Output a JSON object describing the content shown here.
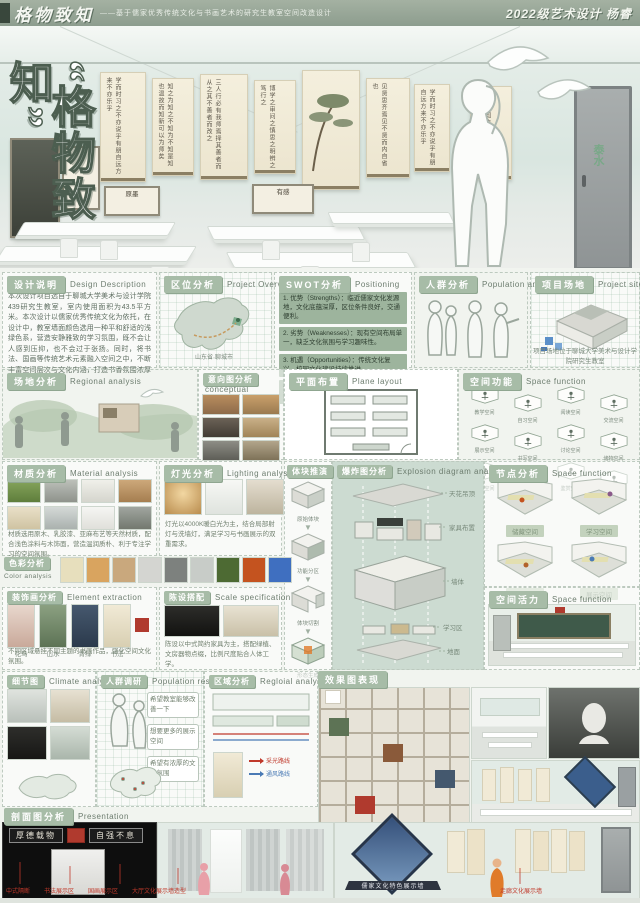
{
  "header": {
    "title": "格物致知",
    "subtitle": "——基于儒家优秀传统文化与书画艺术的研究生教室空间改造设计",
    "class_info": "2022级艺术设计 杨睿"
  },
  "hero": {
    "vertical_title": "“格物致知”",
    "seal": "泰水",
    "scroll_text_1": "学而时习之不亦说乎有朋自远方来不亦乐乎",
    "scroll_text_2": "知之为知之不知为不知是知也温故而知新可以为师矣",
    "scroll_text_3": "三人行必有我师焉择其善者而从之其不善者而改之",
    "scroll_text_4": "博学之审问之慎思之明辨之笃行之",
    "scroll_text_5": "见贤思齐焉见不贤而内自省也",
    "scroll_label_1": "原墨",
    "scroll_label_2": "有感"
  },
  "sections": {
    "design_desc": {
      "zh": "设计说明",
      "en": "Design Description",
      "body": "本次设计项目选自于聊城大学美术与设计学院439研究生教室，室内使用面积为43.5平方米。本次设计以儒家优秀传统文化为依托，在设计中，教室墙面颜色选用一种平和舒适的浅绿色系，营造安静雅致的学习氛围，既不会让人感到压抑，也不会过于张扬。同时，将书法、国画等传统艺术元素融入空间之中，不断丰富空间层次与文化内涵，打造书香氛围浓厚的研究生教室。"
    },
    "location": {
      "zh": "区位分析",
      "en": "Project Overview",
      "note": "山东省·聊城市"
    },
    "swot": {
      "zh": "SWOT分析",
      "en": "Positioning",
      "items": [
        "1. 优势（Strengths）：临近儒家文化发源地，文化底蕴深厚，区位条件良好，交通便利。",
        "2. 劣势（Weaknesses）：现有空间布局单一，缺乏文化氛围与学习趣味性。",
        "3. 机遇（Opportunities）：传统文化复兴，校园文化建设持续推进。",
        "4. 威胁（Threats）：改造预算有限，空间面积较小，采光条件一般。"
      ]
    },
    "population": {
      "zh": "人群分析",
      "en": "Population analysis"
    },
    "site": {
      "zh": "项目场地",
      "en": "Project site",
      "caption": "项目场地位于聊城大学美术与设计学院研究生教室"
    },
    "regional": {
      "zh": "场地分析",
      "en": "Regional analysis"
    },
    "conceptual": {
      "zh": "意向图分析",
      "en": "conceptual"
    },
    "plan": {
      "zh": "平面布置",
      "en": "Plane layout"
    },
    "space_function": {
      "zh": "空间功能",
      "en": "Space function",
      "labels": [
        "教学空间",
        "自习空间",
        "阅读空间",
        "交流空间",
        "展示空间",
        "书写空间",
        "讨论空间",
        "储物空间",
        "绘画空间",
        "休闲空间",
        "鉴赏空间",
        "实践空间"
      ]
    },
    "material": {
      "zh": "材质分析",
      "en": "Material analysis",
      "note": "材质选用原木、乳胶漆、亚麻布艺等天然材质，配合浅色涂料与木饰面，营造温润质朴、利于专注学习的空间氛围。"
    },
    "lighting": {
      "zh": "灯光分析",
      "en": "Lighting analysis",
      "note": "灯光以4000K暖白光为主，结合局部射灯与洗墙灯，满足学习与书画展示的双重需求。"
    },
    "massing": {
      "zh": "体块推演",
      "steps": [
        "原始体块",
        "功能分区",
        "体块切割",
        "形态生成"
      ]
    },
    "explosion": {
      "zh": "爆炸图分析",
      "en": "Explosion diagram analysis",
      "layers": [
        "天花吊顶",
        "家具布置",
        "墙体",
        "学习区",
        "地面"
      ]
    },
    "node": {
      "zh": "节点分析",
      "en": "Space function",
      "rooms": [
        "储藏空间",
        "学习空间",
        "教学空间",
        "展示空间"
      ]
    },
    "color": {
      "zh": "色彩分析",
      "en": "Color analysis",
      "swatches": [
        "#e7dfbd",
        "#d9a45f",
        "#c9a87d",
        "#d4d5d1",
        "#7d817e",
        "#c8ccc8",
        "#4d6a33",
        "#c4531f",
        "#3f6fc0"
      ]
    },
    "decor": {
      "zh": "装饰画分析",
      "en": "Element extraction",
      "captions": [
        "花鸟",
        "山水",
        "青绿",
        "书法"
      ],
      "note": "不同区域悬挂不同主题的书画作品，强化空间文化氛围。"
    },
    "furnishing": {
      "zh": "陈设搭配",
      "en": "Scale specification",
      "note": "陈设以中式简约家具为主，搭配绿植、文房器物点缀，比例尺度贴合人体工学。"
    },
    "vitality": {
      "zh": "空间活力",
      "en": "Space function"
    },
    "detail": {
      "zh": "细节图",
      "en": "Climate analysis"
    },
    "research": {
      "zh": "人群调研",
      "en": "Population research",
      "bubbles": [
        "希望教室能够改善一下",
        "想要更多的展示空间",
        "希望有浓厚的文化氛围"
      ]
    },
    "zone": {
      "zh": "区域分析",
      "en": "Regloial analysis",
      "legend_light": "采光路线",
      "legend_wind": "通风路线"
    },
    "render": {
      "zh": "效果图表现"
    },
    "section_view": {
      "zh": "剖面图分析",
      "en": "Presentation"
    }
  },
  "elevation": {
    "plaque_left": "厚德载物",
    "plaque_right": "自强不息",
    "banner": "儒家文化特色展示墙",
    "labels": [
      "中式隔断",
      "书法展示区",
      "国画展示区",
      "大厅文化展示墙造型"
    ],
    "label_right": "走廊文化展示墙"
  },
  "colors": {
    "accent": "#a7bca7",
    "red": "#c0392b",
    "blue": "#4a7ab5"
  }
}
